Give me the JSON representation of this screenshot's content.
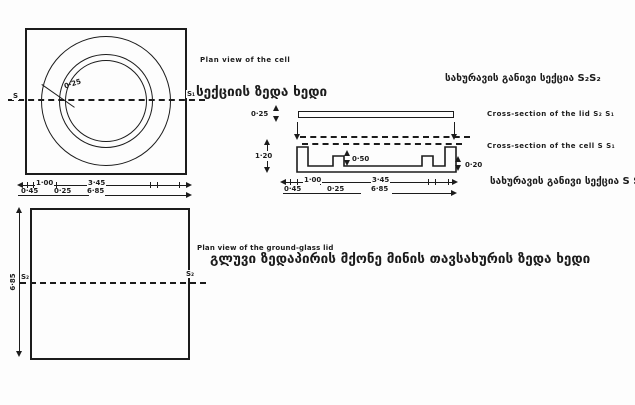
{
  "palette": {
    "ink": "#1c1c1c",
    "paper": "#fdfdfd"
  },
  "plan_cell": {
    "caption_en": "Plan view of the cell",
    "caption_ka": "სექციის ზედა ხედი",
    "section_label_left": "S",
    "section_label_right": "S₁",
    "wall_gap_dim": "0·25",
    "dims": {
      "inner_step": "1·00",
      "edge": "0·45",
      "wall": "0·25",
      "cavity": "3·45",
      "overall": "6·85"
    }
  },
  "lid_cross_section": {
    "caption_ka": "სახურავის განივი სექცია S₂S₂",
    "caption_en": "Cross-section of the lid S₂ S₁",
    "thickness_dim": "0·25"
  },
  "cell_cross_section": {
    "caption_en": "Cross-section of the cell S S₁",
    "caption_ka": "სახურავის განივი სექცია  S S₁",
    "height_dim": "1·20",
    "ridge_dim": "0·50",
    "base_dim": "0·20",
    "dims": {
      "inner_step": "1·00",
      "edge": "0·45",
      "wall": "0·25",
      "cavity": "3·45",
      "overall": "6·85"
    }
  },
  "plan_lid": {
    "caption_en": "Plan view of the ground-glass lid",
    "caption_ka": "გლუვი ზედაპირის მქონე მინის თავსახურის ზედა ხედი",
    "height_dim": "6·85",
    "section_label_left": "S₂",
    "section_label_right": "S₂"
  }
}
